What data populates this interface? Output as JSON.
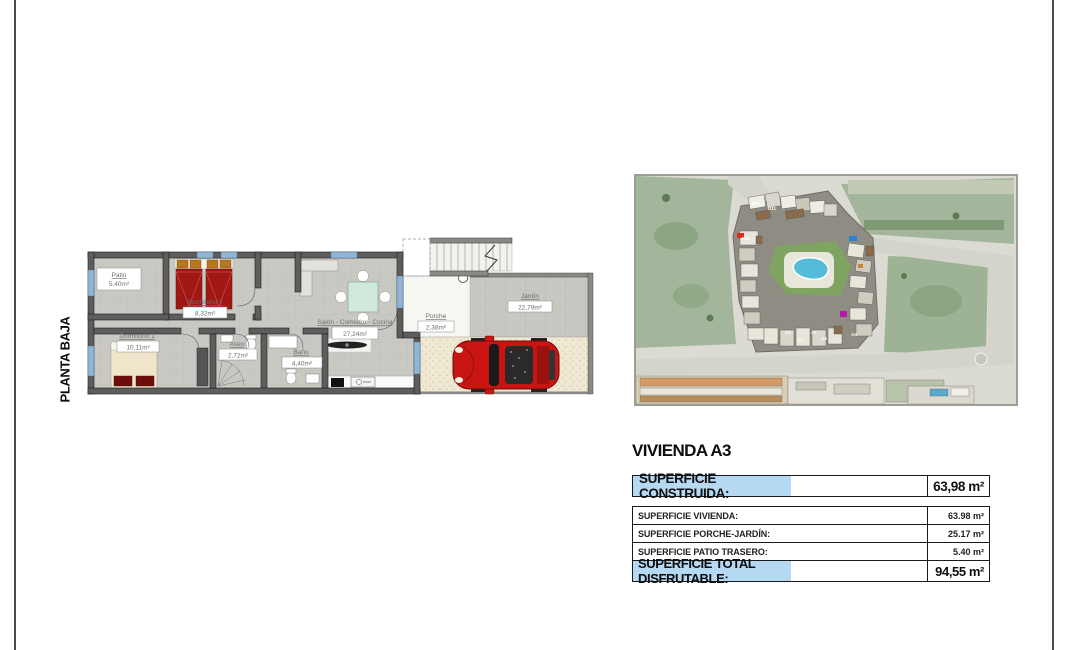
{
  "plan": {
    "floor_label": "PLANTA BAJA",
    "rooms": [
      {
        "name": "Patio",
        "area": "5,40m²"
      },
      {
        "name": "Dormitorio 2",
        "area": "8,32m²"
      },
      {
        "name": "Dormitorio 1",
        "area": "10,11m²"
      },
      {
        "name": "Aseo",
        "area": "2,72m²"
      },
      {
        "name": "Baño",
        "area": "4,40m²"
      },
      {
        "name": "Salón - Comedor - Cocina",
        "area": "27,24m²"
      },
      {
        "name": "Porche",
        "area": "2,38m²"
      },
      {
        "name": "Jardín",
        "area": "22,79m²"
      }
    ]
  },
  "site_map": {
    "unit_labels": [
      "D12",
      "D11",
      "D13",
      "A5",
      "A2",
      "A7",
      "A3",
      "A4"
    ]
  },
  "panel": {
    "title": "VIVIENDA A3",
    "construida": {
      "label": "SUPERFICIE CONSTRUIDA:",
      "value": "63,98 m²"
    },
    "rows": [
      {
        "label": "SUPERFICIE VIVIENDA:",
        "value": "63.98 m²"
      },
      {
        "label": "SUPERFICIE PORCHE-JARDÍN:",
        "value": "25.17 m²"
      },
      {
        "label": "SUPERFICIE PATIO TRASERO:",
        "value": "5.40 m²"
      }
    ],
    "total": {
      "label": "SUPERFICIE TOTAL DISFRUTABLE:",
      "value": "94,55 m²"
    }
  },
  "colors": {
    "highlight": "#b5d8f3",
    "wall": "#5d5d5d",
    "floor": "#cac8c3",
    "bed_red": "#a01713",
    "car_red": "#c81511",
    "pool_blue": "#54bcd9",
    "window_blue": "#8fb4d4",
    "field_green": "#a3b69b",
    "lawn_green": "#7fa361"
  }
}
